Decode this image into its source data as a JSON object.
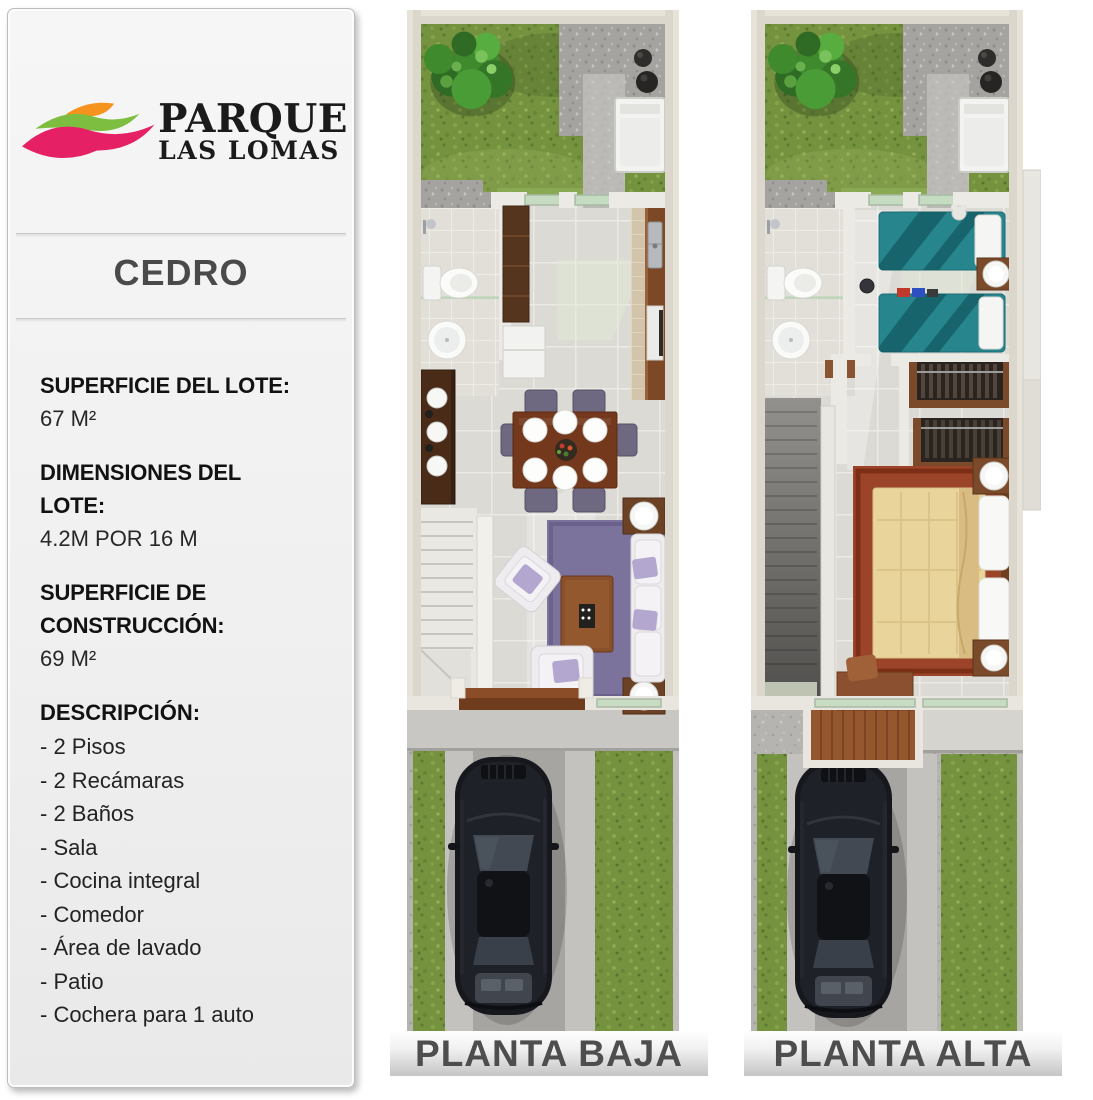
{
  "brand": {
    "line1": "PARQUE",
    "line2": "LAS LOMAS",
    "logo_colors": {
      "orange": "#F6921E",
      "green": "#7DBE40",
      "pink": "#E62064"
    }
  },
  "model_title": "CEDRO",
  "specs": [
    {
      "label1": "SUPERFICIE DEL LOTE:",
      "value": "67 M²"
    },
    {
      "label1": "DIMENSIONES DEL",
      "label2": "LOTE:",
      "value": "4.2M POR 16 M"
    },
    {
      "label1": "SUPERFICIE DE",
      "label2": "CONSTRUCCIÓN:",
      "value": "69 M²"
    }
  ],
  "description": {
    "label": "DESCRIPCIÓN:",
    "items": [
      "- 2 Pisos",
      "- 2 Recámaras",
      "- 2 Baños",
      "- Sala",
      "- Cocina integral",
      "- Comedor",
      "- Área de lavado",
      "- Patio",
      "- Cochera para 1 auto"
    ]
  },
  "plan_labels": {
    "baja": "PLANTA BAJA",
    "alta": "PLANTA ALTA"
  },
  "label_text_color": "#4E4E4E"
}
